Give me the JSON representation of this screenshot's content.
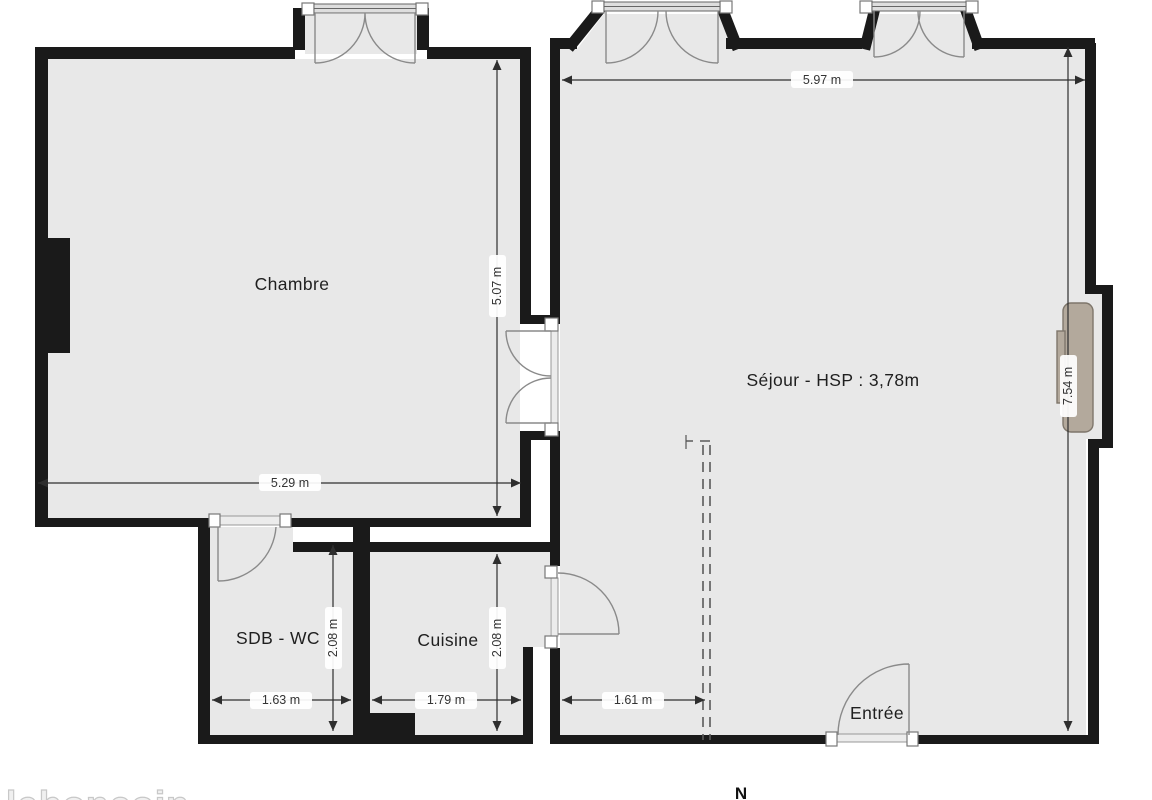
{
  "floorplan": {
    "rooms": {
      "chambre": {
        "label": "Chambre"
      },
      "sejour": {
        "label": "Séjour - HSP : 3,78m"
      },
      "sdb_wc": {
        "label": "SDB - WC"
      },
      "cuisine": {
        "label": "Cuisine"
      },
      "entree": {
        "label": "Entrée"
      }
    },
    "dimensions": {
      "sejour_width": "5.97 m",
      "chambre_height": "5.07 m",
      "chambre_width": "5.29 m",
      "sejour_height": "7.54 m",
      "sdb_wc_height": "2.08 m",
      "cuisine_height": "2.08 m",
      "sdb_wc_width": "1.63 m",
      "cuisine_width": "1.79 m",
      "entry_zone_width": "1.61 m"
    },
    "compass": {
      "north_label": "N"
    },
    "watermark": {
      "text": "leboncoin"
    },
    "colors": {
      "wall": "#1a1a1a",
      "floor": "#e8e8e8",
      "background": "#ffffff",
      "fireplace": "#b3a99c",
      "dim_text": "#333333",
      "swing": "#8a8a8a"
    }
  }
}
